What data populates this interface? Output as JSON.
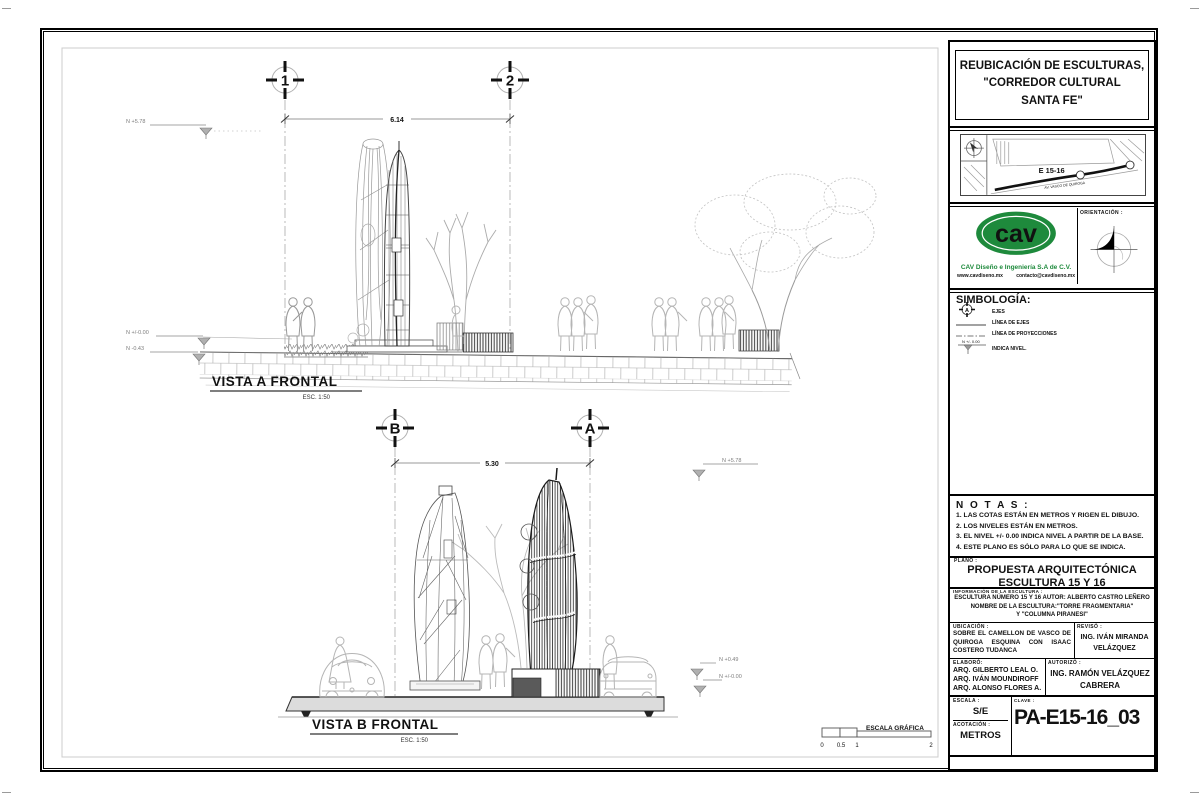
{
  "title_block": {
    "project_title": [
      "REUBICACIÓN DE ESCULTURAS,",
      "\"CORREDOR CULTURAL",
      "SANTA FE\""
    ],
    "map": {
      "site_label": "E 15-16",
      "road_label": "AV. VASCO DE QUIROGA"
    },
    "company": {
      "logo": "cav",
      "name": "CAV Diseño e Ingeniería S.A de C.V.",
      "website": "www.cavdiseno.mx",
      "email": "contacto@cavdiseno.mx",
      "brand_green": "#1e8a3c"
    },
    "orientacion_label": "ORIENTACIÓN :",
    "simbologia": {
      "title": "SIMBOLOGÍA:",
      "axis_symbol_letter": "A",
      "level_symbol_text": "N +/- 0.00",
      "items": [
        "EJES",
        "LÍNEA DE EJES",
        "LÍNEA DE PROYECCIONES",
        "INDICA NIVEL."
      ]
    },
    "notas": {
      "title": "N O T A S :",
      "items": [
        "1. LAS COTAS ESTÁN EN METROS Y  RIGEN EL DIBUJO.",
        "2. LOS NIVELES ESTÁN EN METROS.",
        "3. EL NIVEL +/- 0.00 INDICA NIVEL  A PARTIR DE LA BASE.",
        "4. ESTE PLANO ES SÓLO PARA LO QUE SE INDICA."
      ]
    },
    "plano": {
      "label": "PLANO :",
      "lines": [
        "PROPUESTA ARQUITECTÓNICA",
        "ESCULTURA 15 Y 16"
      ]
    },
    "info": {
      "label": "INFORMACIÓN DE LA ESCULTURA :",
      "lines": [
        "ESCULTURA NÚMERO 15 Y 16 AUTOR: ALBERTO CASTRO LEÑERO",
        "NOMBRE DE LA ESCULTURA:\"TORRE FRAGMENTARIA\"",
        "Y \"COLUMNA PIRANESI\""
      ]
    },
    "ubicacion": {
      "label": "UBICACIÓN :",
      "text": "SOBRE  EL  CAMELLON  DE  VASCO  DE QUIROGA    ESQUINA    CON    ISAAC COSTERO TUDANCA"
    },
    "reviso": {
      "label": "REVISÓ :",
      "lines": [
        "ING. IVÁN MIRANDA",
        "VELÁZQUEZ"
      ]
    },
    "elaboro": {
      "label": "ELABORÓ:",
      "lines": [
        "ARQ. GILBERTO LEAL O.",
        "ARQ. IVÁN MOUNDIROFF",
        "ARQ. ALONSO FLORES A."
      ]
    },
    "autorizo": {
      "label": "AUTORIZÓ :",
      "lines": [
        "ING. RAMÓN VELÁZQUEZ",
        "CABRERA"
      ]
    },
    "escala": {
      "label": "ESCALA :",
      "value": "S/E"
    },
    "acotacion": {
      "label": "ACOTACIÓN :",
      "value": "METROS"
    },
    "clave": {
      "label": "CLAVE :",
      "value": "PA-E15-16_03"
    }
  },
  "view_a": {
    "title": "VISTA A FRONTAL",
    "scale": "ESC. 1:50",
    "axes": [
      "1",
      "2"
    ],
    "dimension": "6.14",
    "levels": {
      "top": "N +5.78",
      "mid": "N +/-0.00",
      "low": "N -0.43"
    }
  },
  "view_b": {
    "title": "VISTA B FRONTAL",
    "scale": "ESC. 1:50",
    "axes": [
      "B",
      "A"
    ],
    "dimension": "5.30",
    "levels": {
      "top": "N +5.78",
      "mid": "N +0.49",
      "low": "N +/-0.00"
    }
  },
  "scale_bar": {
    "label": "ESCALA GRÁFICA",
    "ticks": [
      "0",
      "0.5",
      "1",
      "2"
    ]
  }
}
